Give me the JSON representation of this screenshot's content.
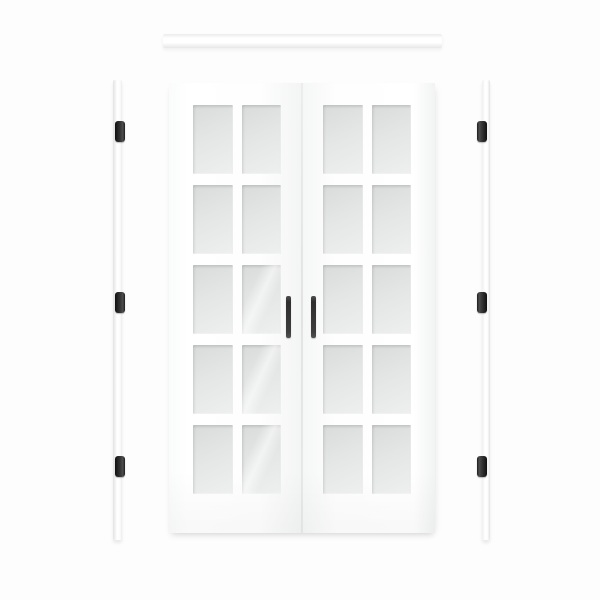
{
  "image": {
    "type": "product-photo",
    "alt": "White prehung French double door with frosted glass lites, shown with top header jamb, two side jambs with black hinges, and two black bar pulls",
    "background_color": "#fdfdfd"
  },
  "door_unit": {
    "face_color": "#ffffff",
    "glass_color_top": "#d8dbda",
    "glass_color_bottom": "#eef0ef",
    "panels": [
      {
        "id": "left-door",
        "lite_rows": 5,
        "lite_cols": 2,
        "lite_count": 10
      },
      {
        "id": "right-door",
        "lite_rows": 5,
        "lite_cols": 2,
        "lite_count": 10
      }
    ],
    "total_lites": 20,
    "reflection_lites": [
      [
        0,
        2,
        1
      ],
      [
        0,
        3,
        1
      ],
      [
        0,
        4,
        1
      ]
    ]
  },
  "hardware": {
    "handles": {
      "count": 2,
      "style": "vertical-bar-pull",
      "color": "#3d3d3d"
    },
    "hinges": {
      "count": 6,
      "per_jamb": 3,
      "finish": "matte-black",
      "color": "#1c1c1c"
    }
  },
  "frame": {
    "header_jamb": {
      "color": "#ffffff"
    },
    "side_jambs": {
      "count": 2,
      "color": "#ffffff"
    }
  }
}
